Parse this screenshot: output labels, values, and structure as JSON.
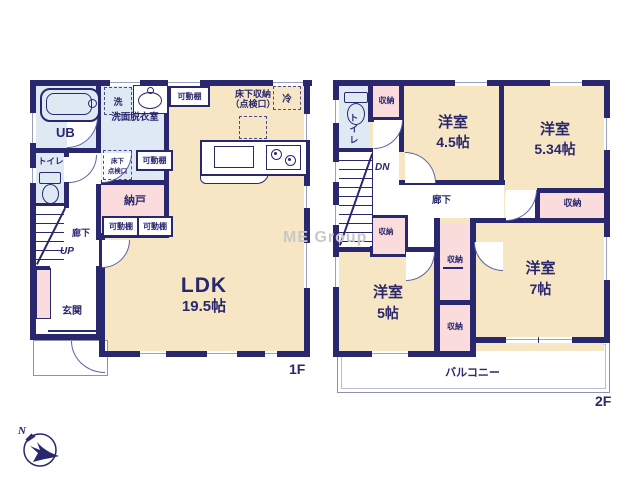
{
  "watermark": "ME Group",
  "compass": {
    "north": "N"
  },
  "floor1": {
    "floor_label": "1F",
    "ldk": {
      "name": "LDK",
      "size": "19.5帖"
    },
    "entrance": "玄関",
    "storeroom": "納戸",
    "washroom": "洗面脱衣室",
    "bath": "UB",
    "toilet": "トイレ",
    "corridor": "廊下",
    "up": "UP",
    "washer": "洗",
    "underfloor_hatch": [
      "床下",
      "点検口"
    ],
    "underfloor_storage": [
      "床下収納",
      "（点検口）"
    ],
    "fridge": "冷",
    "shelf": "可動棚"
  },
  "floor2": {
    "floor_label": "2F",
    "bedroom_a": {
      "name": "洋室",
      "size": "4.5帖"
    },
    "bedroom_b": {
      "name": "洋室",
      "size": "5.34帖"
    },
    "bedroom_c": {
      "name": "洋室",
      "size": "5帖"
    },
    "bedroom_d": {
      "name": "洋室",
      "size": "7帖"
    },
    "toilet": "トイレ",
    "corridor": "廊下",
    "closet": "収納",
    "dn": "DN",
    "balcony": "バルコニー"
  },
  "colors": {
    "wall": "#29276e",
    "room_beige": "#f7e6c3",
    "room_pink": "#fadcdc",
    "room_blue": "#dee9f4",
    "balcony_line": "#8e91b0",
    "watermark_gray": "#c8c8c8"
  }
}
